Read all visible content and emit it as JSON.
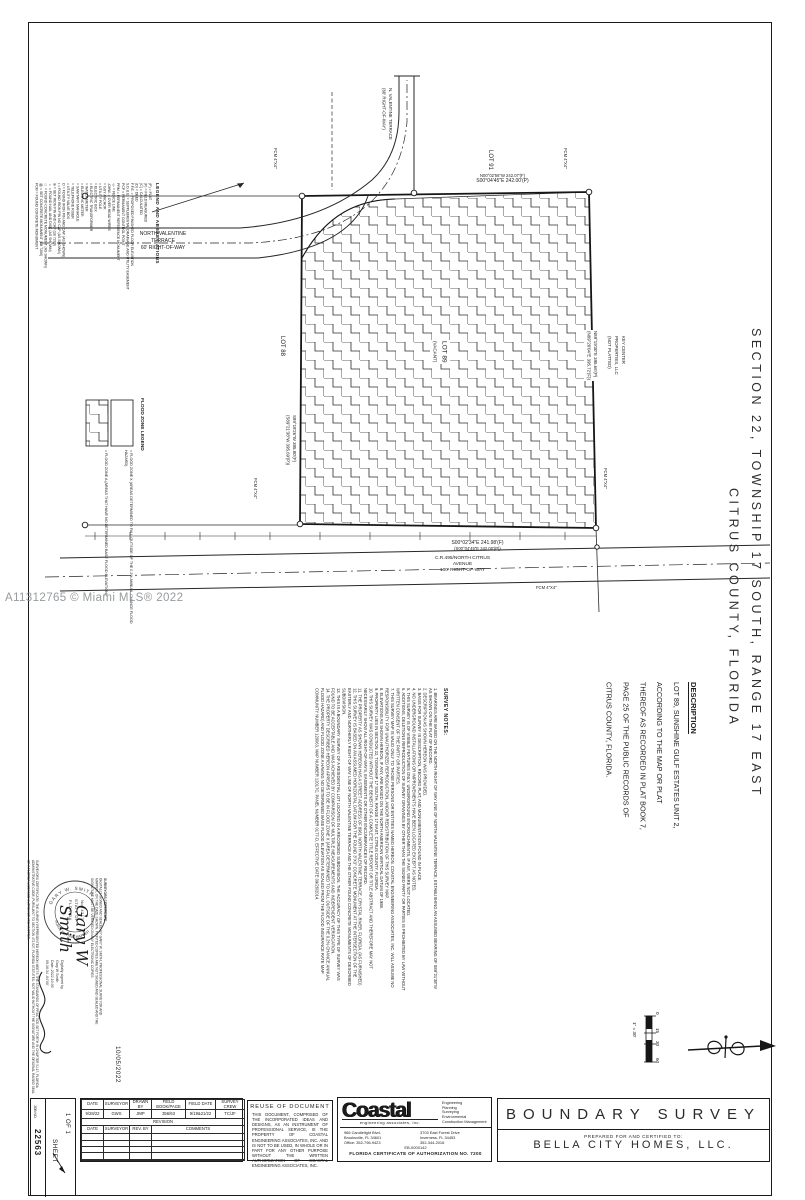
{
  "watermark": "A11312765 © Miami MLS® 2022",
  "map": {
    "road_top": {
      "l1": "NORTH VALENTINE",
      "l2": "TERRACE",
      "l3": "60' RIGHT-OF-WAY"
    },
    "road_vertical": {
      "l1": "N. VALENTINE TERRACE",
      "l2": "(60' RIGHT-OF-WAY)"
    },
    "road_bottom": {
      "l1": "C.R.495/NORTH CITRUS",
      "l2": "AVENUE",
      "l3": "100' RIGHT-OF-WAY"
    },
    "bearing_top": {
      "l1": "N00°02'56\"W  242.07'(F)",
      "l2": "S00°04'45\"E  242.00'(P)"
    },
    "bearing_bottom": {
      "l1": "S00°02'34\"E  241.98'(F)",
      "l2": "(S00°04'45\"E  242.00'(P))"
    },
    "bearing_left": {
      "l1": "S89°18'26\"W  395.80'(F)",
      "l2": "(S89°21'38\"W  395.69'(P))"
    },
    "bearing_right": {
      "l1": "N89°19'30\"E  395.66'(P)",
      "l2": "(N89°20'04\"E  395.72'(F))"
    },
    "lot88": "LOT 88",
    "lot89_l1": "LOT 89",
    "lot89_l2": "(VACANT)",
    "lot91": "LOT 91",
    "corner_marker": "FCM 4\"X4\"",
    "adjacent_owner": [
      "KEY CENTER",
      "PROPERTIES, LLC",
      "(NOT PLATTED)"
    ],
    "scale": {
      "title": "1\" = 30'",
      "ticks": [
        "0",
        "15",
        "30",
        "60"
      ]
    }
  },
  "legend": {
    "title": "LEGEND AND ABBREVIATIONS",
    "entries": [
      "(P) = PLAT",
      "(F) = FIELD MEASURED",
      "(C) = CALCULATED",
      "(D) = DEED",
      "F.F.E. = PROPOSED FINISHED FLOOR ELEVATION",
      "S.D.U.E. = SUPPLEMENTAL DRAINAGE AND UTILITY EASEMENT",
      "PCP = PERMANENT CONTROL POINT",
      "PRM = PERMANENT REFERENCE MONUMENT",
      "-x- = FENCE LINE",
      "-OHW- = OVER HEAD WIRES",
      "= GUY ANCHOR",
      "= UTILITY POLE",
      "= ELECTRIC BOX",
      "= ELECTRIC TRANSFORMER",
      "= WATER METER",
      "= ELECTRIC METER",
      "= SANITARY MANHOLE",
      "= TELEPHONE RISER",
      "= UTILITY VALVE BOX",
      "O = FOUND IRON PIN AND CAP (AS SHOWN)",
      "• = FOUND IRON PIN NO CAP (AS SHOWN)",
      "⊕ = SET IRON PIN AND CAP (LB 7200)",
      "▪ = FOUND NAIL AND DISK (AS SHOWN)",
      "□ = FOUND CONCRETE MONUMENT (AS SHOWN)",
      "▨ = SET CONCRETE MONUMENT (LB 7200)",
      "FCM = FOUND CONCRETE MONUMENT",
      "= CONCRETE",
      "= PAVERS"
    ],
    "flood": {
      "title": "FLOOD ZONE LEGEND",
      "zone_a": "= FLOOD ZONE A (AREAS THAT HAVE NO DETERMINED BASE FLOOD ELEVATION)",
      "zone_x": "= FLOOD ZONE X (AREAS DETERMINED TO FALL OUTSIDE OF THE 0.2% ANNUAL CHANCE FLOOD HAZARD)"
    }
  },
  "section_title": {
    "line1": "SECTION 22, TOWNSHIP 17 SOUTH, RANGE 17 EAST",
    "line2": "CITRUS COUNTY, FLORIDA"
  },
  "description": {
    "title": "DESCRIPTION",
    "lines": [
      "LOT 89, SUNSHINE GULF ESTATES UNIT 2,",
      "ACCORDING TO THE MAP OR PLAT",
      "THEREOF AS RECORDED IN PLAT BOOK 7,",
      "PAGE 25 OF THE PUBLIC RECORDS OF",
      "CITRUS COUNTY, FLORIDA."
    ]
  },
  "survey_notes": {
    "title": "SURVEY NOTES:",
    "notes": [
      "1. BEARINGS ARE BASED ON THE NORTH RIGHT OF WAY LINE OF NORTH VALENTINE TERRACE, ESTABLISHING AN ASSUMED BEARING OF S89°21'38\"W AS SHOWN ON THE PLAT OF RECORD.",
      "2. DESCRIPTION AS SHOWN HEREON WAS PROVIDED.",
      "3. BASIS FOR SURVEY IS DESCRIPTION, RECORD PLAT, AND MONUMENTATION FOUND IN PLACE.",
      "4. NO UNDERGROUND INSTALLATIONS OR IMPROVEMENTS HAVE BEEN LOCATED EXCEPT AS NOTED.",
      "5. THIS SURVEY IS OF VISIBLE FEATURES ONLY. UNDERGROUND ENCROACHMENTS, IF ANY, WERE NOT LOCATED.",
      "6. ADDITIONS, DELETIONS REPRODUCTION OF SURVEY DRAWINGS BY OTHER THAN THE SIGNED PARTY OR PARTIES IS PROHIBITED BY LAW WITHOUT WRITTEN CONSENT OF THE PARTY OR PARTIES.",
      "7. THIS SURVEY MAP IS VALID ONLY TO THOSE PERSONS OR ENTITIES NAMED HEREON. COASTAL ENGINEERING ASSOCIATES, INC. WILL ASSUME NO RESPONSIBILITY FOR UNAUTHORIZED REPRODUCTION, AND/OR REDISTRIBUTION OF THIS SURVEY MAP.",
      "8. ELEVATIONS AS SHOWN HEREON, IF ANY, ARE BASED ON THE NORTH AMERICAN VERTICAL DATUM OF 1988.",
      "9. PROPERTY LIES IN SECTION 22, TOWNSHIP 17 SOUTH, RANGE 17 EAST, CITRUS COUNTY, FLORIDA.",
      "10. THIS SURVEY WAS CONDUCTED WITHOUT THE BENEFIT OF A COMPLETE TITLE REPORT OR TITLE ABSTRACT AND THEREFORE MAY NOT NECESSARILY SHOW ALL RIGHT-OF-WAYS, EASEMENTS OR OTHER ENCUMBRANCES OF RECORD.",
      "11. THE PROPERTY AS SHOWN HEREON HAS A STREET ADDRESS OF 8961 NORTH VALENTINE TERRACE, CRYSTAL RIVER, FLORIDA. (AS FURNISHED)",
      "12. THIS SURVEY IS BASED ON AN ASSUMED HORIZONTAL DATUM FOR THE FOUND 3\"X3\" CONCRETE MONUMENT AT THE INTERSECTION OF THE EASTERLY AND NORTHERLY RIGHT OF WAY LINE OF NORTH VALENTINE TERRACE AND THE OTHER FOUND CONCRETE MONUMENTS OF DESCRIBED SUBDIVISION.",
      "13. THIS IS A BOUNDARY SURVEY OF A RESIDENTIAL LOT LOCATED IN A RECORDED SUBDIVISION. THE ACCURACY OF THIS TYPE OF SURVEY WAS FOUND TO BE ACCEPTABLE AND WAS ACHIEVED BY COMPARISON OF MULTIPLE MEASUREMENTS AND INDEPENDENT VERIFICATION.",
      "14. THE PROPERTY DESCRIBED HEREON APPEARS TO BE IN FLOOD ZONE X (AREA DETERMINED TO FALL OUTSIDE OF THE 0.2% CHANCE ANNUAL FLOOD HAZARD) AND FLOOD ZONE A HAVING NO DETERMINED BASE FLOOD ELEVATION AS SCALED FROM THE FLOOD INSURANCE RATE MAP COMMUNITY NUMBER 120063, MAP NUMBER 12017C, PANEL NUMBER 0177-D, EFFECTIVE DATE 09/26/2014."
    ]
  },
  "certificate": {
    "legal_column": "SURVEYORS CERTIFICATE: THE SURVEY REPRESENTED HEREON MEETS THE STANDARDS OF PRACTICE SET FORTH IN CHAPTER 5J-17, FLORIDA ADMINISTRATIVE CODE, PURSUANT TO SECTION 472.027, FLORIDA STATUTES. NOT VALID WITHOUT THE SIGNATURE AND THE ORIGINAL RAISED SEAL OF A FLORIDA LICENSED SURVEYOR AND MAPPER.",
    "heading": "SURVEYORS CERTIFICATE",
    "body": "DIGITALLY SIGNED AND SEALED BY GARY W. SMITH, PROFESSIONAL SURVEYOR AND MAPPER, ON THE DATE SHOWN. PRINTED COPIES ARE NOT SIGNED AND SEALED AND THE SIGNATURE MUST BE VERIFIED ON ANY ELECTRONIC COPIES.",
    "signature_l1": "Gary W",
    "signature_l2": "Smith",
    "digital": [
      "Digitally signed by",
      "Gary W Smith",
      "Date: 2022.10.05",
      "09:16:34 -04'00'"
    ],
    "date": "10/05/2022",
    "seal": {
      "arc_top": "GARY W. SMITH",
      "arc_bottom": "SURVEYOR AND MAPPER",
      "center": [
        "No. 4317",
        "STATE OF",
        "FLORIDA"
      ]
    }
  },
  "sheet_box": {
    "job_label": "JOB NO.",
    "job_number": "22563",
    "sheet_word": "SHEET",
    "sheet_count": "1 OF 1"
  },
  "title_block": {
    "table": {
      "headers": [
        "DATE",
        "SURVEYOR",
        "DRAWN BY",
        "FIELD BOOK/PAGE",
        "FIELD DATE",
        "SURVEY CREW"
      ],
      "row": [
        "9/28/22",
        "GWS",
        "JMP",
        "356/63",
        "9/19&21/22",
        "TC/JF"
      ],
      "revision_label": "REVISION",
      "rev_headers": [
        "DATE",
        "SURVEYOR",
        "REV. BY",
        "COMMENTS"
      ]
    },
    "reuse": {
      "title": "REUSE OF DOCUMENT",
      "body": "THIS DOCUMENT, COMPRISED OF THE INCORPORATED IDEAS AND DESIGNS, AS AN INSTRUMENT OF PROFESSIONAL SERVICE, IS THE PROPERTY OF COASTAL ENGINEERING ASSOCIATES, INC. AND IS NOT TO BE USED, IN WHOLE OR IN PART FOR ANY OTHER PURPOSE WITHOUT THE WRITTEN AUTHORIZATION OF COASTAL ENGINEERING ASSOCIATES, INC."
    },
    "coastal": {
      "logo": "Coastal",
      "sub": "engineering associates, inc.",
      "services": [
        "Engineering",
        "Planning",
        "Surveying",
        "Environmental",
        "Construction Management"
      ],
      "addr1": [
        "966 Candlelight Blvd.",
        "Brooksville, FL 34601",
        "Office: 352-796-9423"
      ],
      "addr2": [
        "3703 East Forest Drive",
        "Inverness, FL 34453",
        "352-344-2016"
      ],
      "eb": "EB-0000142",
      "cert": "FLORIDA CERTIFICATE OF AUTHORIZATION NO. 7200"
    },
    "survey": {
      "title": "BOUNDARY SURVEY",
      "prepared": "PREPARED FOR AND CERTIFIED TO:",
      "client": "BELLA CITY HOMES, LLC."
    }
  }
}
